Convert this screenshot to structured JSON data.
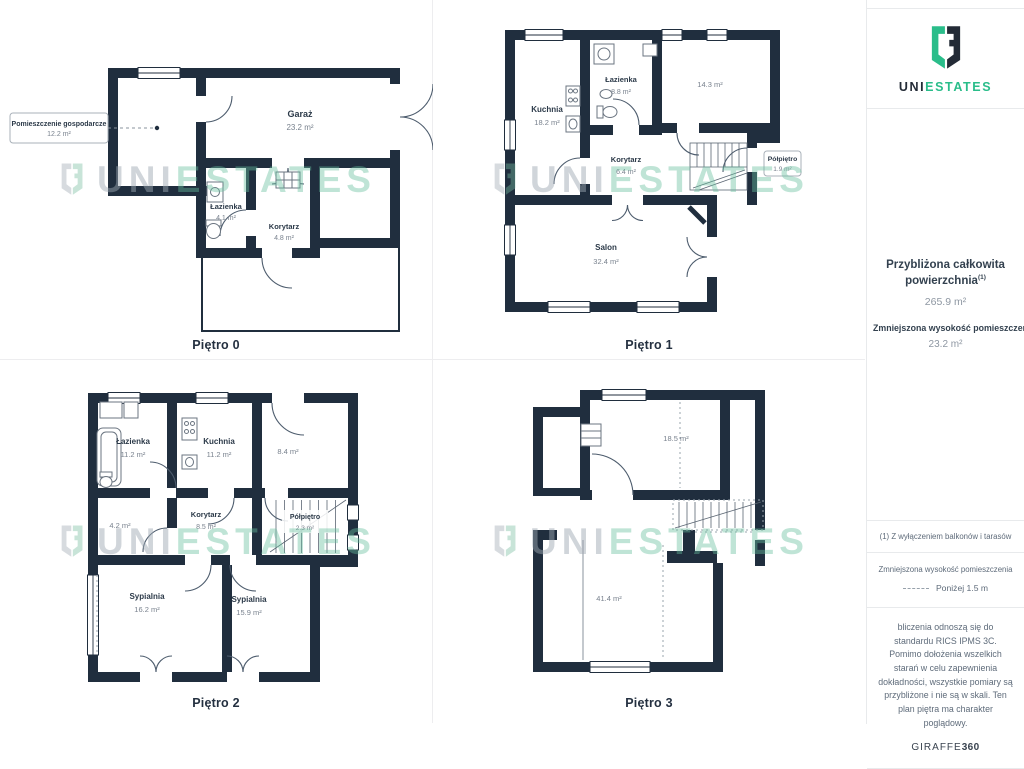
{
  "brand": {
    "name_primary": "UNI",
    "name_secondary": "ESTATES",
    "green": "#2abd8a",
    "dark": "#232b36"
  },
  "floors": [
    {
      "label": "Piętro 0",
      "rooms": [
        {
          "name": "Pomieszczenie gospodarcze",
          "area": "12.2 m²"
        },
        {
          "name": "Garaż",
          "area": "23.2 m²"
        },
        {
          "name": "Łazienka",
          "area": "4.1 m²"
        },
        {
          "name": "Korytarz",
          "area": "4.8 m²"
        }
      ]
    },
    {
      "label": "Piętro 1",
      "rooms": [
        {
          "name": "Kuchnia",
          "area": "18.2 m²"
        },
        {
          "name": "Łazienka",
          "area": "8.8 m²"
        },
        {
          "name": "",
          "area": "14.3 m²"
        },
        {
          "name": "Korytarz",
          "area": "6.4 m²"
        },
        {
          "name": "Półpiętro",
          "area": "1.9 m²"
        },
        {
          "name": "Salon",
          "area": "32.4 m²"
        }
      ]
    },
    {
      "label": "Piętro 2",
      "rooms": [
        {
          "name": "Łazienka",
          "area": "11.2 m²"
        },
        {
          "name": "Kuchnia",
          "area": "11.2 m²"
        },
        {
          "name": "",
          "area": "8.4 m²"
        },
        {
          "name": "",
          "area": "4.2 m²"
        },
        {
          "name": "Korytarz",
          "area": "8.5 m²"
        },
        {
          "name": "Półpiętro",
          "area": "2.3 m²"
        },
        {
          "name": "Sypialnia",
          "area": "16.2 m²"
        },
        {
          "name": "Sypialnia",
          "area": "15.9 m²"
        }
      ]
    },
    {
      "label": "Piętro 3",
      "rooms": [
        {
          "name": "",
          "area": "18.5 m²"
        },
        {
          "name": "",
          "area": "41.4 m²"
        }
      ]
    }
  ],
  "sidebar": {
    "summary": {
      "total_label": "Przybliżona całkowita powierzchnia",
      "total_sup": "(1)",
      "total_value": "265.9 m²",
      "reduced_label": "Zmniejszona wysokość pomieszczenia",
      "reduced_value": "23.2 m²"
    },
    "footnote": "(1) Z wyłączeniem balkonów i tarasów",
    "legend": {
      "title": "Zmniejszona wysokość pomieszczenia",
      "item": "Poniżej 1.5 m"
    },
    "disclaimer": "bliczenia odnoszą się do standardu RICS IPMS 3C. Pomimo dołożenia wszelkich starań w celu zapewnienia dokładności, wszystkie pomiary są przybliżone i nie są w skali. Ten plan piętra ma charakter poglądowy.",
    "credit_brand": "GIRAFFE",
    "credit_suffix": "360"
  }
}
